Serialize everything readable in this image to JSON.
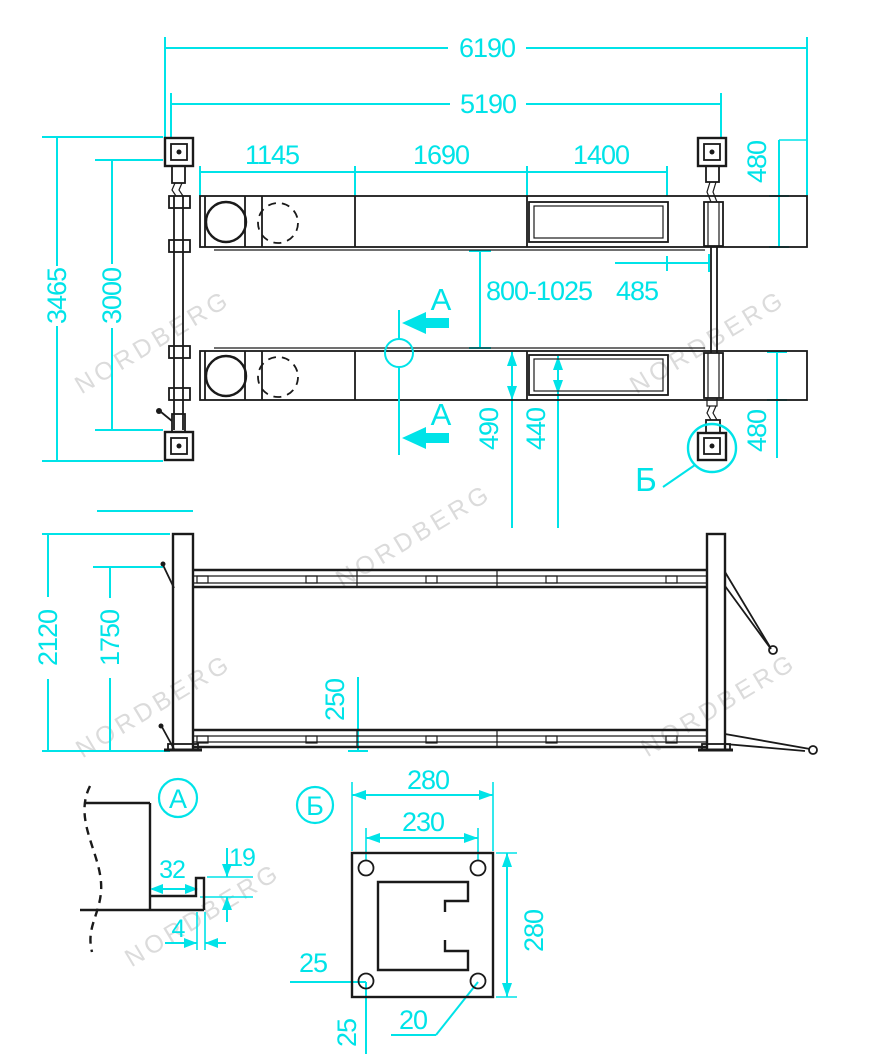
{
  "watermark": {
    "text": "NORDBERG"
  },
  "colors": {
    "dimension_cyan": "#00e3e8",
    "line_black": "#1a1a1a",
    "watermark_gray": "#d9d9d9"
  },
  "plan": {
    "overall_length": "6190",
    "inner_length": "5190",
    "seg_1": "1145",
    "seg_2": "1690",
    "seg_3": "1400",
    "wheel_stop_offset": "485",
    "runway_gap": "800-1025",
    "runway_width": "490",
    "runway_inner_width": "440",
    "ramp_width_front": "480",
    "ramp_width_rear": "480",
    "overall_width": "3465",
    "inner_width": "3000",
    "section_label_top": "A",
    "section_label_bottom": "A",
    "detail_ref_label": "Б"
  },
  "elevation": {
    "overall_height": "2120",
    "lift_height": "1750",
    "lowered_height": "250"
  },
  "detail_a": {
    "title": "A",
    "flange_width": "32",
    "lip_height": "19",
    "thickness": "4"
  },
  "detail_b": {
    "title": "Б",
    "plate_width": "280",
    "hole_spacing": "230",
    "plate_height": "280",
    "hole_offset_left": "25",
    "hole_offset_bottom": "25",
    "hole_diameter": "20"
  }
}
